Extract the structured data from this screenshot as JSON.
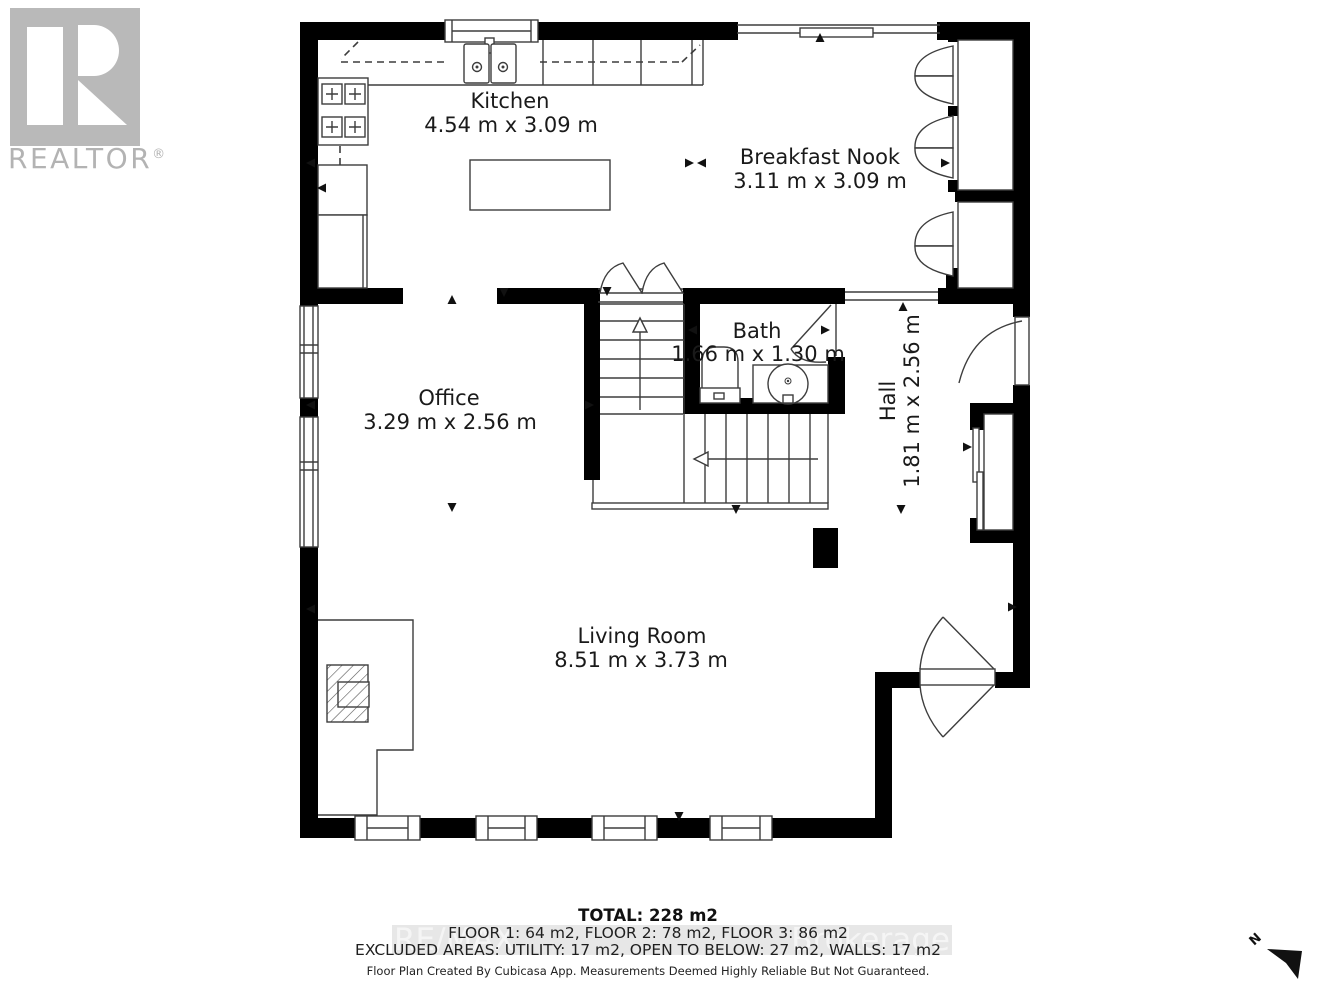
{
  "realtor_logo": {
    "text": "REALTOR",
    "registered": "®"
  },
  "rooms": [
    {
      "name": "Kitchen",
      "dims": "4.54 m x 3.09 m"
    },
    {
      "name": "Breakfast Nook",
      "dims": "3.11 m x 3.09 m"
    },
    {
      "name": "Office",
      "dims": "3.29 m x 2.56 m"
    },
    {
      "name": "Bath",
      "dims": "1.66 m x 1.30 m"
    },
    {
      "name": "Hall",
      "dims": "1.81 m x 2.56 m"
    },
    {
      "name": "Living Room",
      "dims": "8.51 m x 3.73 m"
    }
  ],
  "footer": {
    "total": "TOTAL: 228 m2",
    "floors": "FLOOR 1: 64 m2, FLOOR 2: 78 m2, FLOOR 3: 86 m2",
    "excluded": "EXCLUDED AREAS: UTILITY: 17 m2, OPEN TO BELOW: 27 m2, WALLS: 17 m2",
    "disclaimer": "Floor Plan Created By Cubicasa App. Measurements Deemed Highly Reliable But Not Guaranteed."
  },
  "watermark": {
    "left": "RE/MAX",
    "right": "Brokerage"
  },
  "compass": {
    "label": "N"
  },
  "colors": {
    "wall": "#000000",
    "line": "#3d3d3d",
    "text": "#1a1a1a",
    "logo_gray": "#b9b9b9",
    "watermark_band": "#e7e7e7",
    "watermark_text": "#f5f5f5"
  }
}
